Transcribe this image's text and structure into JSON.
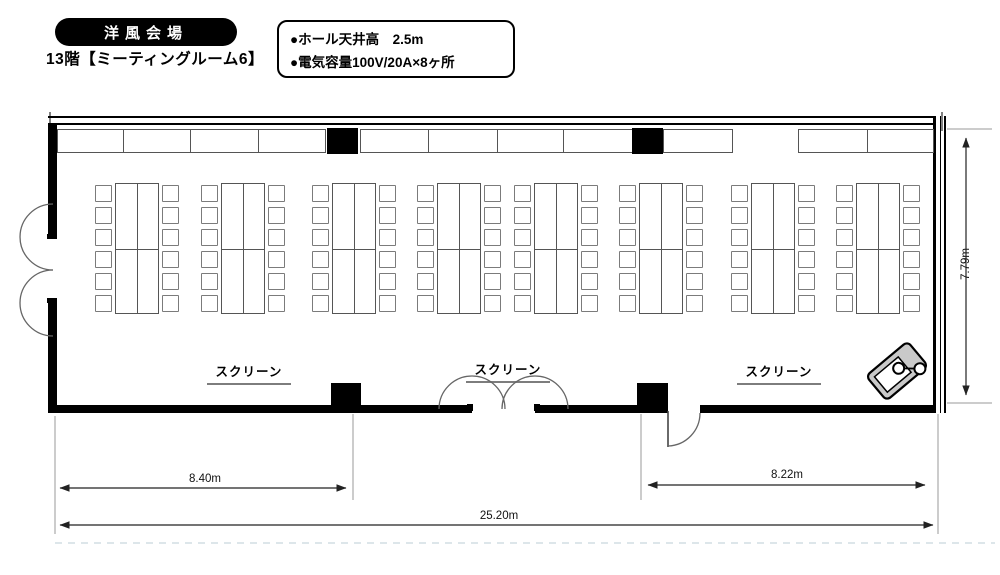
{
  "header": {
    "badge": "洋風会場",
    "subtitle": "13階【ミーティングルーム6】"
  },
  "info_box": {
    "lines": [
      "●ホール天井高　2.5m",
      "●電気容量100V/20A×8ヶ所"
    ]
  },
  "floorplan": {
    "screen_labels": [
      "スクリーン",
      "スクリーン",
      "スクリーン"
    ],
    "dimensions": {
      "left_span": "8.40m",
      "right_span": "8.22m",
      "total_span": "25.20m",
      "depth": "7.79m"
    },
    "furniture": {
      "table_group_count": 8,
      "tables_per_group": 4,
      "chairs_per_group": 12
    },
    "equipment": [
      "projector"
    ]
  },
  "colors": {
    "wall": "#000000",
    "furniture_line": "#555555",
    "badge_bg": "#000000",
    "badge_text": "#ffffff"
  }
}
